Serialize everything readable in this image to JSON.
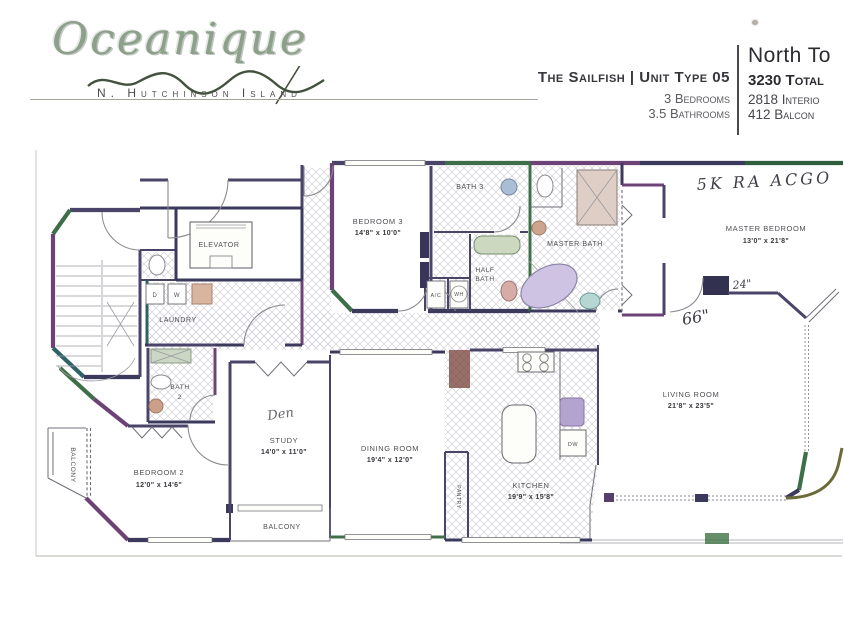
{
  "logo": {
    "name": "Oceanique",
    "subtitle": "N. Hutchinson Island"
  },
  "header": {
    "unit_title": "The Sailfish | Unit Type 05",
    "bedrooms": "3 Bedrooms",
    "bathrooms": "3.5 Bathrooms",
    "tower": "North To",
    "total_sf": "3230 Total",
    "interior_sf": "2818 Interio",
    "balcony_sf": "412 Balcon"
  },
  "rooms": {
    "elevator": {
      "label": "ELEVATOR"
    },
    "laundry": {
      "label": "LAUNDRY",
      "dryer": "D",
      "washer": "W"
    },
    "bath3": {
      "label": "BATH 3"
    },
    "bedroom3": {
      "label": "BEDROOM 3",
      "dims": "14'8\" x 10'0\""
    },
    "half_bath": {
      "line1": "HALF",
      "line2": "BATH"
    },
    "ac_closet": {
      "label": "A/C"
    },
    "water_heater": {
      "label": "WH"
    },
    "master_bath": {
      "label": "MASTER BATH"
    },
    "master_bedroom": {
      "label": "MASTER BEDROOM",
      "dims": "13'0\" x 21'8\""
    },
    "bath2": {
      "line1": "BATH",
      "line2": "2"
    },
    "bedroom2": {
      "label": "BEDROOM 2",
      "dims": "12'0\" x 14'6\""
    },
    "balcony_left": {
      "label": "BALCONY"
    },
    "study": {
      "label": "STUDY",
      "dims": "14'0\" x 11'0\""
    },
    "dining": {
      "label": "DINING ROOM",
      "dims": "19'4\" x 12'0\""
    },
    "kitchen": {
      "label": "KITCHEN",
      "dims": "19'9\" x 15'8\""
    },
    "pantry": {
      "label": "PANTRY"
    },
    "dishwasher": {
      "label": "DW"
    },
    "living": {
      "label": "LIVING ROOM",
      "dims": "21'8\" x 23'5\""
    },
    "balcony_bottom": {
      "label": "BALCONY"
    }
  },
  "annotations": {
    "note": "5K RA ACGO",
    "closet_width": "24\"",
    "wall_length": "66\"",
    "study_scribble": "Den"
  },
  "palette": {
    "paper": "#f5f3ef",
    "ink": "#4f4f54",
    "wall_navy": "#3b3a5c",
    "wall_purple": "#6d4377",
    "wall_green": "#3f6f49",
    "wall_maroon": "#7e4a44"
  }
}
